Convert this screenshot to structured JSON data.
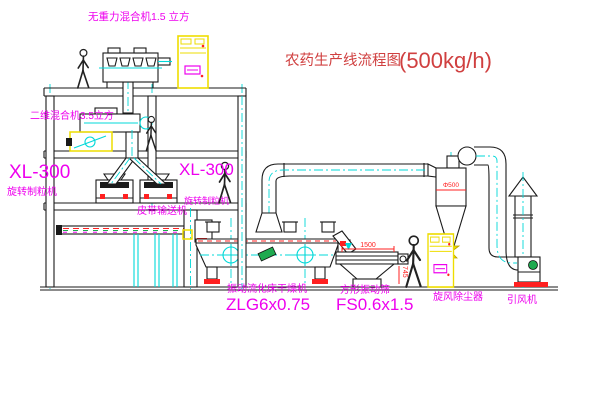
{
  "title": {
    "name": "农药生产线流程图",
    "capacity": "(500kg/h)"
  },
  "labels": {
    "gravity_free_mixer": "无重力混合机1.5 立方",
    "two_dim_mixer": "二维混合机3.5立方",
    "granulator_left_model": "XL-300",
    "granulator_left_name": "旋转制粒机",
    "granulator_right_model": "XL-300",
    "granulator_right_name": "旋转制粒机",
    "belt_conveyor": "皮带输送机",
    "dryer_name": "振动流化床干燥机",
    "dryer_model": "ZLG6x0.75",
    "sieve_name": "方形振动筛",
    "sieve_model": "FS0.6x1.5",
    "cyclone_name": "旋风除尘器",
    "fan_name": "引风机"
  },
  "dimensions": {
    "sieve_length": "1500",
    "sieve_height": "745",
    "cyclone_diameter": "Φ500"
  },
  "colors": {
    "label_magenta": "#ee00ee",
    "title_red": "#d04040",
    "dimension_red": "#ff2020",
    "centerline_cyan": "#00d8d8",
    "cabinet_yellow": "#eedd00",
    "line_black": "#1a1a1a",
    "motor_green": "#1faa50",
    "background": "#ffffff"
  }
}
